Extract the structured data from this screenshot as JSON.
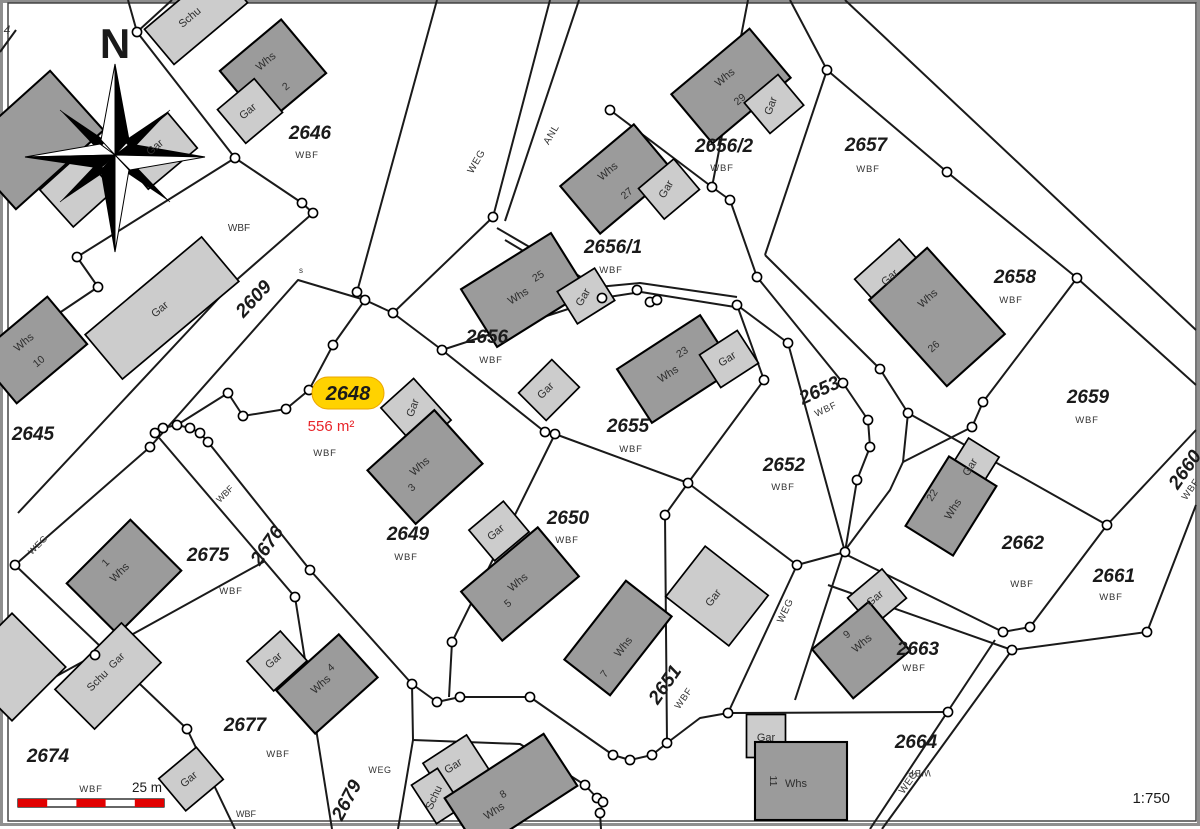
{
  "map": {
    "north_label": "N",
    "scale": {
      "bar_label": "25 m",
      "ratio": "1:750"
    },
    "highlight": {
      "parcel": "2648",
      "area": "556 m²",
      "land_use": "WBF",
      "x": 348,
      "y": 400,
      "area_x": 331,
      "area_y": 431,
      "wbf_x": 325,
      "wbf_y": 456
    },
    "colors": {
      "highlight_fill": "#FFD200",
      "highlight_stroke": "#EBA400",
      "area_text": "#E8252A",
      "building_dark": "#9B9B9B",
      "building_light": "#CCCCCC",
      "outline": "#000000",
      "boundary": "#1A1A1A",
      "scale_red": "#E10000"
    },
    "parcels": [
      {
        "num": "2646",
        "x": 310,
        "y": 139,
        "rot": 0,
        "wbf": {
          "x": 307,
          "y": 158,
          "rot": 0
        }
      },
      {
        "num": "2645",
        "x": 33,
        "y": 440,
        "rot": 0,
        "wbf": null
      },
      {
        "num": "2649",
        "x": 408,
        "y": 540,
        "rot": 0,
        "wbf": {
          "x": 406,
          "y": 560,
          "rot": 0
        }
      },
      {
        "num": "2650",
        "x": 568,
        "y": 524,
        "rot": 0,
        "wbf": {
          "x": 567,
          "y": 543,
          "rot": 0
        }
      },
      {
        "num": "2651",
        "x": 670,
        "y": 688,
        "rot": -55,
        "wbf": {
          "x": 686,
          "y": 700,
          "rot": -55
        }
      },
      {
        "num": "2652",
        "x": 784,
        "y": 471,
        "rot": 0,
        "wbf": {
          "x": 783,
          "y": 490,
          "rot": 0
        }
      },
      {
        "num": "2653",
        "x": 822,
        "y": 396,
        "rot": -25,
        "wbf": {
          "x": 827,
          "y": 412,
          "rot": -25
        }
      },
      {
        "num": "2655",
        "x": 628,
        "y": 432,
        "rot": 0,
        "wbf": {
          "x": 631,
          "y": 452,
          "rot": 0
        }
      },
      {
        "num": "2656",
        "x": 487,
        "y": 343,
        "rot": 0,
        "wbf": {
          "x": 491,
          "y": 363,
          "rot": 0
        }
      },
      {
        "num": "2656/1",
        "x": 613,
        "y": 253,
        "rot": 0,
        "wbf": {
          "x": 611,
          "y": 273,
          "rot": 0
        }
      },
      {
        "num": "2656/2",
        "x": 724,
        "y": 152,
        "rot": 0,
        "wbf": {
          "x": 722,
          "y": 171,
          "rot": 0
        }
      },
      {
        "num": "2657",
        "x": 866,
        "y": 151,
        "rot": 0,
        "wbf": {
          "x": 868,
          "y": 172,
          "rot": 0
        }
      },
      {
        "num": "2658",
        "x": 1015,
        "y": 283,
        "rot": 0,
        "wbf": {
          "x": 1011,
          "y": 303,
          "rot": 0
        }
      },
      {
        "num": "2659",
        "x": 1088,
        "y": 403,
        "rot": 0,
        "wbf": {
          "x": 1087,
          "y": 423,
          "rot": 0
        }
      },
      {
        "num": "2660",
        "x": 1190,
        "y": 473,
        "rot": -55,
        "wbf": {
          "x": 1193,
          "y": 491,
          "rot": -55
        }
      },
      {
        "num": "2661",
        "x": 1114,
        "y": 582,
        "rot": 0,
        "wbf": {
          "x": 1111,
          "y": 600,
          "rot": 0
        }
      },
      {
        "num": "2662",
        "x": 1023,
        "y": 549,
        "rot": 0,
        "wbf": {
          "x": 1022,
          "y": 587,
          "rot": 0
        }
      },
      {
        "num": "2663",
        "x": 918,
        "y": 655,
        "rot": 0,
        "wbf": {
          "x": 914,
          "y": 671,
          "rot": 0
        }
      },
      {
        "num": "2664",
        "x": 916,
        "y": 748,
        "rot": 0,
        "wbf": {
          "x": 919,
          "y": 770,
          "rot": 180
        }
      },
      {
        "num": "2674",
        "x": 48,
        "y": 762,
        "rot": 0,
        "wbf": {
          "x": 91,
          "y": 792,
          "rot": 0
        }
      },
      {
        "num": "2675",
        "x": 208,
        "y": 561,
        "rot": 0,
        "wbf": {
          "x": 231,
          "y": 594,
          "rot": 0
        }
      },
      {
        "num": "2677",
        "x": 245,
        "y": 731,
        "rot": 0,
        "wbf": {
          "x": 278,
          "y": 757,
          "rot": 0
        }
      },
      {
        "num": "2609",
        "x": 258,
        "y": 303,
        "rot": -47,
        "wbf": null
      },
      {
        "num": "2676",
        "x": 272,
        "y": 549,
        "rot": -55,
        "wbf": null
      },
      {
        "num": "2679",
        "x": 352,
        "y": 803,
        "rot": -62,
        "wbf": null
      }
    ],
    "path_labels": [
      {
        "text": "WEG",
        "x": 479,
        "y": 163,
        "rot": -60,
        "size": 10
      },
      {
        "text": "ANL",
        "x": 554,
        "y": 136,
        "rot": -60,
        "size": 10
      },
      {
        "text": "WEG",
        "x": 788,
        "y": 612,
        "rot": -65,
        "size": 10
      },
      {
        "text": "WEG",
        "x": 911,
        "y": 784,
        "rot": -55,
        "size": 10
      },
      {
        "text": "WEG",
        "x": 40,
        "y": 547,
        "rot": -45,
        "size": 9
      },
      {
        "text": "WEG",
        "x": 380,
        "y": 773,
        "rot": 0,
        "size": 9
      }
    ],
    "misc_labels": [
      {
        "text": "WBF",
        "x": 239,
        "y": 231,
        "rot": 0,
        "size": 10
      },
      {
        "text": "WBF",
        "x": 227,
        "y": 496,
        "rot": -45,
        "size": 9
      },
      {
        "text": "WBF",
        "x": 246,
        "y": 817,
        "rot": 0,
        "size": 9
      },
      {
        "text": "4",
        "x": 7,
        "y": 34,
        "rot": 0,
        "size": 12,
        "italic": true
      },
      {
        "text": "s",
        "x": 301,
        "y": 273,
        "rot": 0,
        "size": 8
      }
    ],
    "buildings": [
      {
        "id": "whs-topleft",
        "label": "",
        "num": ""
      },
      {
        "id": "gar-a",
        "label": "",
        "num": ""
      },
      {
        "id": "gar-b",
        "label": "Gar",
        "lx": 157,
        "ly": 150,
        "lrot": -40,
        "num": ""
      },
      {
        "id": "schu-top",
        "label": "Schu",
        "lx": 192,
        "ly": 20,
        "lrot": -40,
        "num": ""
      },
      {
        "id": "whs-2",
        "label": "Whs",
        "lx": 268,
        "ly": 64,
        "lrot": -40,
        "num": "2",
        "nx": 288,
        "ny": 89,
        "nrot": -40
      },
      {
        "id": "gar-2",
        "label": "Gar",
        "lx": 250,
        "ly": 114,
        "lrot": -40,
        "num": ""
      },
      {
        "id": "gar-big",
        "label": "Gar",
        "lx": 162,
        "ly": 312,
        "lrot": -40,
        "num": ""
      },
      {
        "id": "whs-10",
        "label": "Whs",
        "lx": 26,
        "ly": 345,
        "lrot": -40,
        "num": "10",
        "nx": 41,
        "ny": 364,
        "nrot": -40
      },
      {
        "id": "whs-29",
        "label": "Whs",
        "lx": 727,
        "ly": 80,
        "lrot": -40,
        "num": "29",
        "nx": 742,
        "ny": 102,
        "nrot": -40
      },
      {
        "id": "gar-29",
        "label": "Gar",
        "lx": 774,
        "ly": 107,
        "lrot": -70,
        "num": ""
      },
      {
        "id": "whs-27",
        "label": "Whs",
        "lx": 610,
        "ly": 174,
        "lrot": -40,
        "num": "27",
        "nx": 629,
        "ny": 196,
        "nrot": -40
      },
      {
        "id": "gar-27",
        "label": "Gar",
        "lx": 669,
        "ly": 191,
        "lrot": -60,
        "num": ""
      },
      {
        "id": "whs-25",
        "label": "Whs",
        "lx": 520,
        "ly": 299,
        "lrot": -32,
        "num": "25",
        "nx": 540,
        "ny": 279,
        "nrot": -32
      },
      {
        "id": "gar-25",
        "label": "Gar",
        "lx": 586,
        "ly": 299,
        "lrot": -60,
        "num": ""
      },
      {
        "id": "gar-c",
        "label": "Gar",
        "lx": 548,
        "ly": 393,
        "lrot": -45,
        "num": ""
      },
      {
        "id": "whs-23",
        "label": "Whs",
        "lx": 670,
        "ly": 377,
        "lrot": -33,
        "num": "23",
        "nx": 684,
        "ny": 355,
        "nrot": -33
      },
      {
        "id": "gar-23",
        "label": "Gar",
        "lx": 729,
        "ly": 362,
        "lrot": -33,
        "num": ""
      },
      {
        "id": "gar-26",
        "label": "Gar",
        "lx": 892,
        "ly": 280,
        "lrot": -42,
        "num": ""
      },
      {
        "id": "whs-26",
        "label": "Whs",
        "lx": 930,
        "ly": 301,
        "lrot": -42,
        "num": "26",
        "nx": 936,
        "ny": 349,
        "nrot": -42
      },
      {
        "id": "gar-22",
        "label": "Gar",
        "lx": 973,
        "ly": 469,
        "lrot": -58,
        "num": ""
      },
      {
        "id": "whs-22",
        "label": "Whs",
        "lx": 956,
        "ly": 511,
        "lrot": -58,
        "num": "22",
        "nx": 935,
        "ny": 497,
        "nrot": -58
      },
      {
        "id": "gar-9",
        "label": "Gar",
        "lx": 877,
        "ly": 601,
        "lrot": -40,
        "num": ""
      },
      {
        "id": "whs-9",
        "label": "Whs",
        "lx": 864,
        "ly": 646,
        "lrot": -40,
        "num": "9",
        "nx": 849,
        "ny": 637,
        "nrot": -40
      },
      {
        "id": "gar-3",
        "label": "Gar",
        "lx": 416,
        "ly": 409,
        "lrot": -70,
        "num": ""
      },
      {
        "id": "whs-3",
        "label": "Whs",
        "lx": 422,
        "ly": 469,
        "lrot": -42,
        "num": "3",
        "nx": 414,
        "ny": 490,
        "nrot": -42
      },
      {
        "id": "gar-5",
        "label": "Gar",
        "lx": 498,
        "ly": 535,
        "lrot": -40,
        "num": ""
      },
      {
        "id": "whs-5",
        "label": "Whs",
        "lx": 520,
        "ly": 585,
        "lrot": -40,
        "num": "5",
        "nx": 510,
        "ny": 606,
        "nrot": -40
      },
      {
        "id": "whs-7",
        "label": "Whs",
        "lx": 626,
        "ly": 649,
        "lrot": -52,
        "num": "7",
        "nx": 607,
        "ny": 676,
        "nrot": -52
      },
      {
        "id": "gar-7",
        "label": "Gar",
        "lx": 716,
        "ly": 600,
        "lrot": -52,
        "num": ""
      },
      {
        "id": "whs-1",
        "label": "Whs",
        "lx": 122,
        "ly": 575,
        "lrot": -45,
        "num": "1",
        "nx": 108,
        "ny": 565,
        "nrot": -45
      },
      {
        "id": "schu-gar",
        "label": "Schu",
        "lx": 100,
        "ly": 683,
        "lrot": -45,
        "num": "Gar",
        "nx": 119,
        "ny": 663,
        "nrot": -45
      },
      {
        "id": "gar-4",
        "label": "Gar",
        "lx": 276,
        "ly": 663,
        "lrot": -42,
        "num": ""
      },
      {
        "id": "whs-4",
        "label": "Whs",
        "lx": 323,
        "ly": 687,
        "lrot": -42,
        "num": "4",
        "nx": 333,
        "ny": 670,
        "nrot": -42
      },
      {
        "id": "gar-d",
        "label": "Gar",
        "lx": 191,
        "ly": 782,
        "lrot": -40,
        "num": ""
      },
      {
        "id": "gar-8",
        "label": "Gar",
        "lx": 455,
        "ly": 769,
        "lrot": -33,
        "num": ""
      },
      {
        "id": "schu-8",
        "label": "Schu",
        "lx": 437,
        "ly": 799,
        "lrot": -65,
        "num": ""
      },
      {
        "id": "whs-8",
        "label": "Whs",
        "lx": 496,
        "ly": 814,
        "lrot": -33,
        "num": "8",
        "nx": 505,
        "ny": 797,
        "nrot": -33
      },
      {
        "id": "gar-11",
        "label": "Gar",
        "lx": 766,
        "ly": 741,
        "lrot": 0,
        "num": ""
      },
      {
        "id": "whs-11",
        "label": "Whs",
        "lx": 796,
        "ly": 787,
        "lrot": 0,
        "num": "11",
        "nx": 770,
        "ny": 781,
        "nrot": 90
      },
      {
        "id": "gar-edge",
        "label": "",
        "num": ""
      }
    ]
  }
}
